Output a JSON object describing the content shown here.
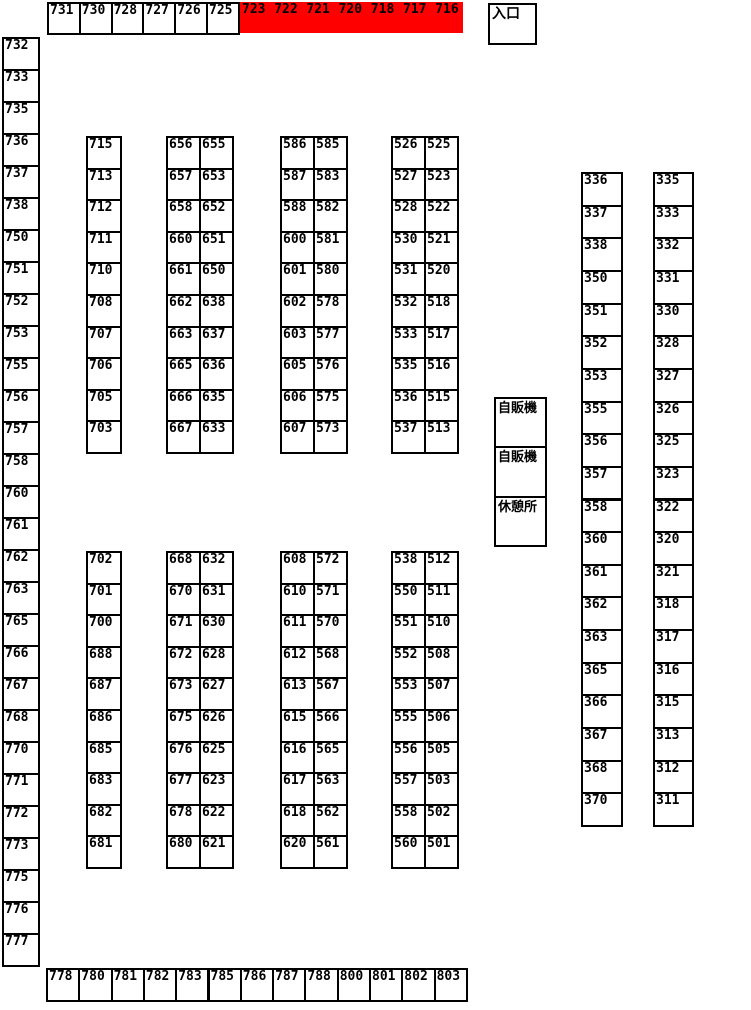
{
  "colors": {
    "highlight_red": "#ff0000",
    "border": "#000000",
    "background": "#ffffff",
    "text": "#000000"
  },
  "entrance": {
    "label": "入口"
  },
  "facilities": [
    "自販機",
    "自販機",
    "休憩所"
  ],
  "top_row": {
    "white": [
      "731",
      "730",
      "728",
      "727",
      "726",
      "725"
    ],
    "red": [
      "723",
      "722",
      "721",
      "720",
      "718",
      "717",
      "716"
    ]
  },
  "left_column": [
    "732",
    "733",
    "735",
    "736",
    "737",
    "738",
    "750",
    "751",
    "752",
    "753",
    "755",
    "756",
    "757",
    "758",
    "760",
    "761",
    "762",
    "763",
    "765",
    "766",
    "767",
    "768",
    "770",
    "771",
    "772",
    "773",
    "775",
    "776",
    "777"
  ],
  "bottom_row": [
    "778",
    "780",
    "781",
    "782",
    "783",
    "785",
    "786",
    "787",
    "788",
    "800",
    "801",
    "802",
    "803"
  ],
  "mid_columns": {
    "single_upper": [
      "715",
      "713",
      "712",
      "711",
      "710",
      "708",
      "707",
      "706",
      "705",
      "703"
    ],
    "single_lower": [
      "702",
      "701",
      "700",
      "688",
      "687",
      "686",
      "685",
      "683",
      "682",
      "681"
    ],
    "pair1_upper_left": [
      "656",
      "657",
      "658",
      "660",
      "661",
      "662",
      "663",
      "665",
      "666",
      "667"
    ],
    "pair1_upper_right": [
      "655",
      "653",
      "652",
      "651",
      "650",
      "638",
      "637",
      "636",
      "635",
      "633"
    ],
    "pair1_lower_left": [
      "668",
      "670",
      "671",
      "672",
      "673",
      "675",
      "676",
      "677",
      "678",
      "680"
    ],
    "pair1_lower_right": [
      "632",
      "631",
      "630",
      "628",
      "627",
      "626",
      "625",
      "623",
      "622",
      "621"
    ],
    "pair2_upper_left": [
      "586",
      "587",
      "588",
      "600",
      "601",
      "602",
      "603",
      "605",
      "606",
      "607"
    ],
    "pair2_upper_right": [
      "585",
      "583",
      "582",
      "581",
      "580",
      "578",
      "577",
      "576",
      "575",
      "573"
    ],
    "pair2_lower_left": [
      "608",
      "610",
      "611",
      "612",
      "613",
      "615",
      "616",
      "617",
      "618",
      "620"
    ],
    "pair2_lower_right": [
      "572",
      "571",
      "570",
      "568",
      "567",
      "566",
      "565",
      "563",
      "562",
      "561"
    ],
    "pair3_upper_left": [
      "526",
      "527",
      "528",
      "530",
      "531",
      "532",
      "533",
      "535",
      "536",
      "537"
    ],
    "pair3_upper_right": [
      "525",
      "523",
      "522",
      "521",
      "520",
      "518",
      "517",
      "516",
      "515",
      "513"
    ],
    "pair3_lower_left": [
      "538",
      "550",
      "551",
      "552",
      "553",
      "555",
      "556",
      "557",
      "558",
      "560"
    ],
    "pair3_lower_right": [
      "512",
      "511",
      "510",
      "508",
      "507",
      "506",
      "505",
      "503",
      "502",
      "501"
    ]
  },
  "right_columns": {
    "inner": [
      "336",
      "337",
      "338",
      "350",
      "351",
      "352",
      "353",
      "355",
      "356",
      "357",
      "358",
      "360",
      "361",
      "362",
      "363",
      "365",
      "366",
      "367",
      "368",
      "370"
    ],
    "outer": [
      "335",
      "333",
      "332",
      "331",
      "330",
      "328",
      "327",
      "326",
      "325",
      "323",
      "322",
      "320",
      "321",
      "318",
      "317",
      "316",
      "315",
      "313",
      "312",
      "311"
    ]
  }
}
